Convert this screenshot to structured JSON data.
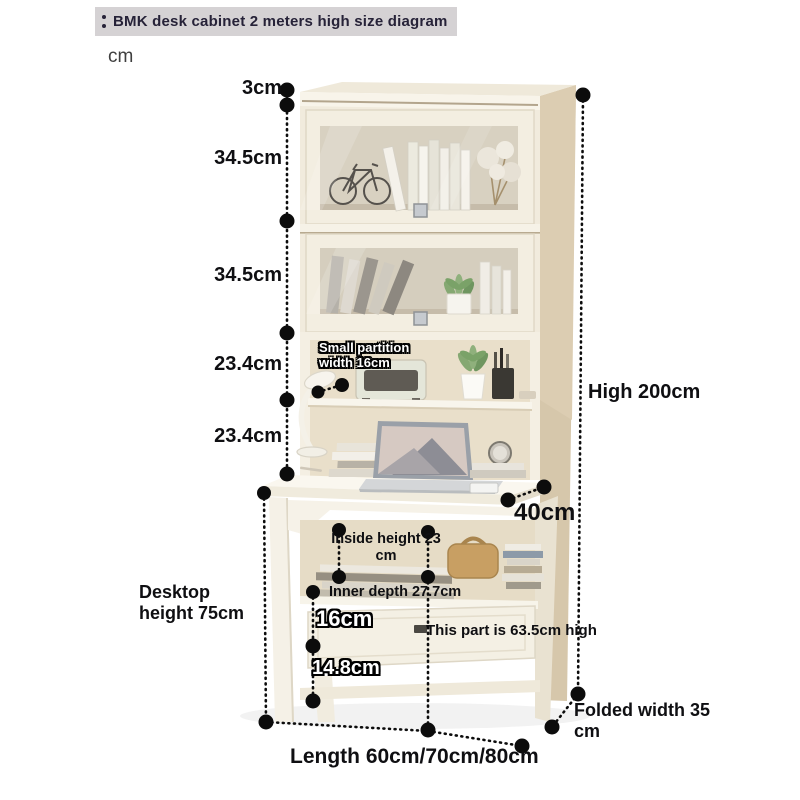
{
  "header": {
    "title": "BMK desk cabinet 2 meters high size diagram",
    "unit_label": "cm"
  },
  "annotations": {
    "top_thickness": "3cm",
    "upper_door_height": "34.5cm",
    "lower_door_height": "34.5cm",
    "upper_shelf_height": "23.4cm",
    "lower_shelf_height": "23.4cm",
    "total_height": "High 200cm",
    "desk_depth": "40cm",
    "partition_line1": "Small partition",
    "partition_line2": "width 16cm",
    "inside_height_line1": "Inside height 23",
    "inside_height_line2": "cm",
    "inner_depth": "Inner depth 27.7cm",
    "drawer_height": "16cm",
    "bottom_gap": "14.8cm",
    "part_height": "This part is 63.5cm high",
    "desktop_line1": "Desktop",
    "desktop_line2": "height 75cm",
    "folded_line1": "Folded width 35",
    "folded_line2": "cm",
    "length": "Length 60cm/70cm/80cm"
  },
  "colors": {
    "title_bg": "#d5d2d4",
    "title_text": "#262238",
    "annotation_text": "#0f0f12",
    "cabinet_front": "#f2ecdf",
    "cabinet_side": "#d6c7ab",
    "glass": "#d0c9b9",
    "plant_green": "#85a872"
  }
}
